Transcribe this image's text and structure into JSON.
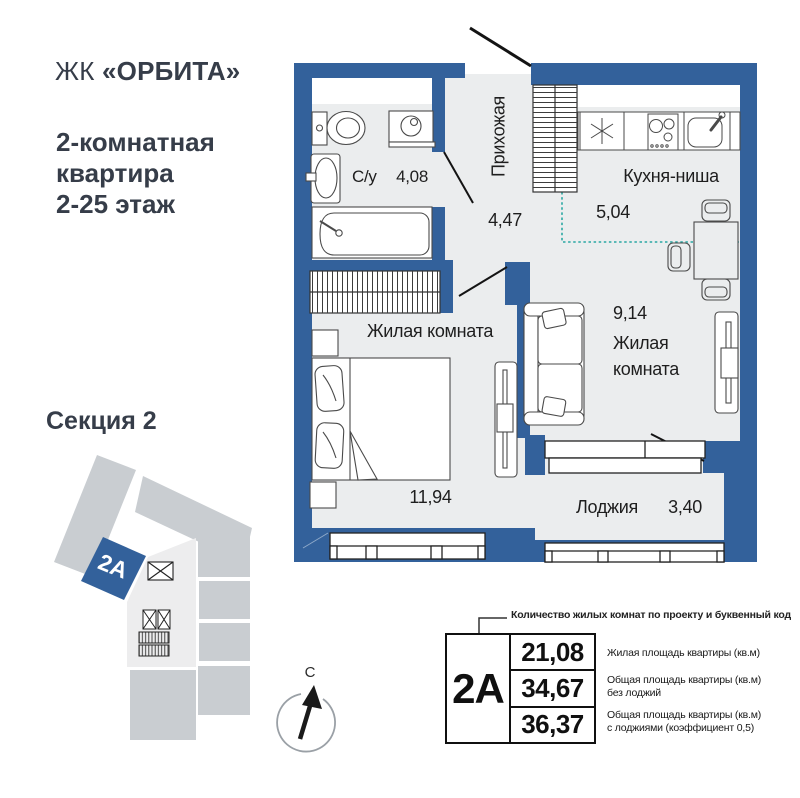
{
  "brand": {
    "prefix": "ЖК ",
    "name": "«ОРБИТА»"
  },
  "subtitle": "2-комнатная\nквартира\n2-25 этаж",
  "section_map": {
    "title": "Секция 2",
    "unit_code": "2A"
  },
  "compass": {
    "north": "С"
  },
  "plan": {
    "rooms": {
      "bathroom": {
        "label": "С/у",
        "area": "4,08"
      },
      "hallway": {
        "label": "Прихожая",
        "area": "4,47"
      },
      "kitchen": {
        "label": "Кухня-ниша",
        "area": "5,04"
      },
      "living_room_1": {
        "label": "Жилая комната",
        "area": "11,94"
      },
      "living_room_2": {
        "label": "Жилая\nкомната",
        "area": "9,14"
      },
      "loggia": {
        "label": "Лоджия",
        "area": "3,40"
      }
    }
  },
  "info_block": {
    "callout": "Количество жилых комнат по проекту и буквенный код",
    "unit_code": "2A",
    "rows": [
      {
        "value": "21,08",
        "description": "Жилая площадь квартиры (кв.м)"
      },
      {
        "value": "34,67",
        "description": "Общая площадь квартиры (кв.м)\nбез лоджий"
      },
      {
        "value": "36,37",
        "description": "Общая площадь квартиры (кв.м)\nс лоджиями (коэффициент 0,5)"
      }
    ]
  },
  "colors": {
    "wall_blue": "#33619b",
    "floor_gray": "#ebedee",
    "kitchen_niche_teal": "#2ba8a4",
    "building_unit_gray": "#c9cdd1",
    "text_dark": "#363d49"
  }
}
